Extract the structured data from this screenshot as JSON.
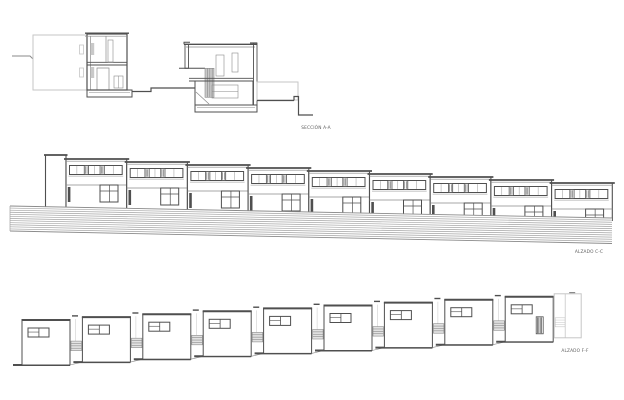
{
  "page": {
    "background": "#ffffff",
    "width": 624,
    "height": 400
  },
  "colors": {
    "line_dark": "#4f4f4f",
    "line_mid": "#8a8a8a",
    "ghost": "#c6c6c6",
    "hatch_line": "#a3a3a3",
    "hatch_fill": "#c9c9c9",
    "label": "#5f5f5f"
  },
  "section": {
    "label": "SECCIÓN A-A",
    "label_pos": {
      "x": 316,
      "y": 129
    }
  },
  "elevation_street": {
    "label": "ALZADO C-C",
    "label_pos": {
      "x": 589,
      "y": 253
    },
    "units": 9,
    "start_x": 66,
    "unit_width": 60.7,
    "roof_y_start": 159,
    "roof_step": 3.0,
    "tower": {
      "x": 45.5,
      "width": 20.5,
      "top_y": 155
    },
    "ribbon": {
      "dy": 6.5,
      "h": 9,
      "inset": 3.5,
      "hatched_panes": [
        [
          0.28,
          0.36
        ],
        [
          0.58,
          0.66
        ]
      ],
      "thin_mullions": [
        0.14,
        0.47,
        0.83
      ]
    },
    "door": {
      "dx": 1.8,
      "dy": 28,
      "w": 2.6,
      "h": 15
    },
    "window": {
      "dx": 34,
      "dy": 26,
      "w": 18,
      "h": 17
    },
    "band": {
      "x0": 10,
      "x1": 612,
      "top_y0": 206,
      "top_y1": 218,
      "bottom_y0": 231,
      "bottom_y1": 243.5,
      "lines": 12
    }
  },
  "elevation_patio": {
    "label": "ALZADO F-F",
    "label_pos": {
      "x": 575,
      "y": 352
    },
    "units": 9,
    "start_x": 22,
    "pitch": 60.4,
    "box_width": 48,
    "box_height": 45,
    "top_y_start": 320,
    "top_step": -2.9,
    "window": {
      "dx": 6,
      "dy": 8,
      "w": 21,
      "h": 9
    },
    "gap_strip": {
      "w": 10.5,
      "h": 9.5,
      "above_base": 21
    },
    "louver": {
      "dx": 31,
      "dy": 20,
      "w": 7,
      "h": 17
    },
    "ghost": {
      "dx": 1,
      "dy": -3,
      "w": 27,
      "h": 44
    }
  }
}
